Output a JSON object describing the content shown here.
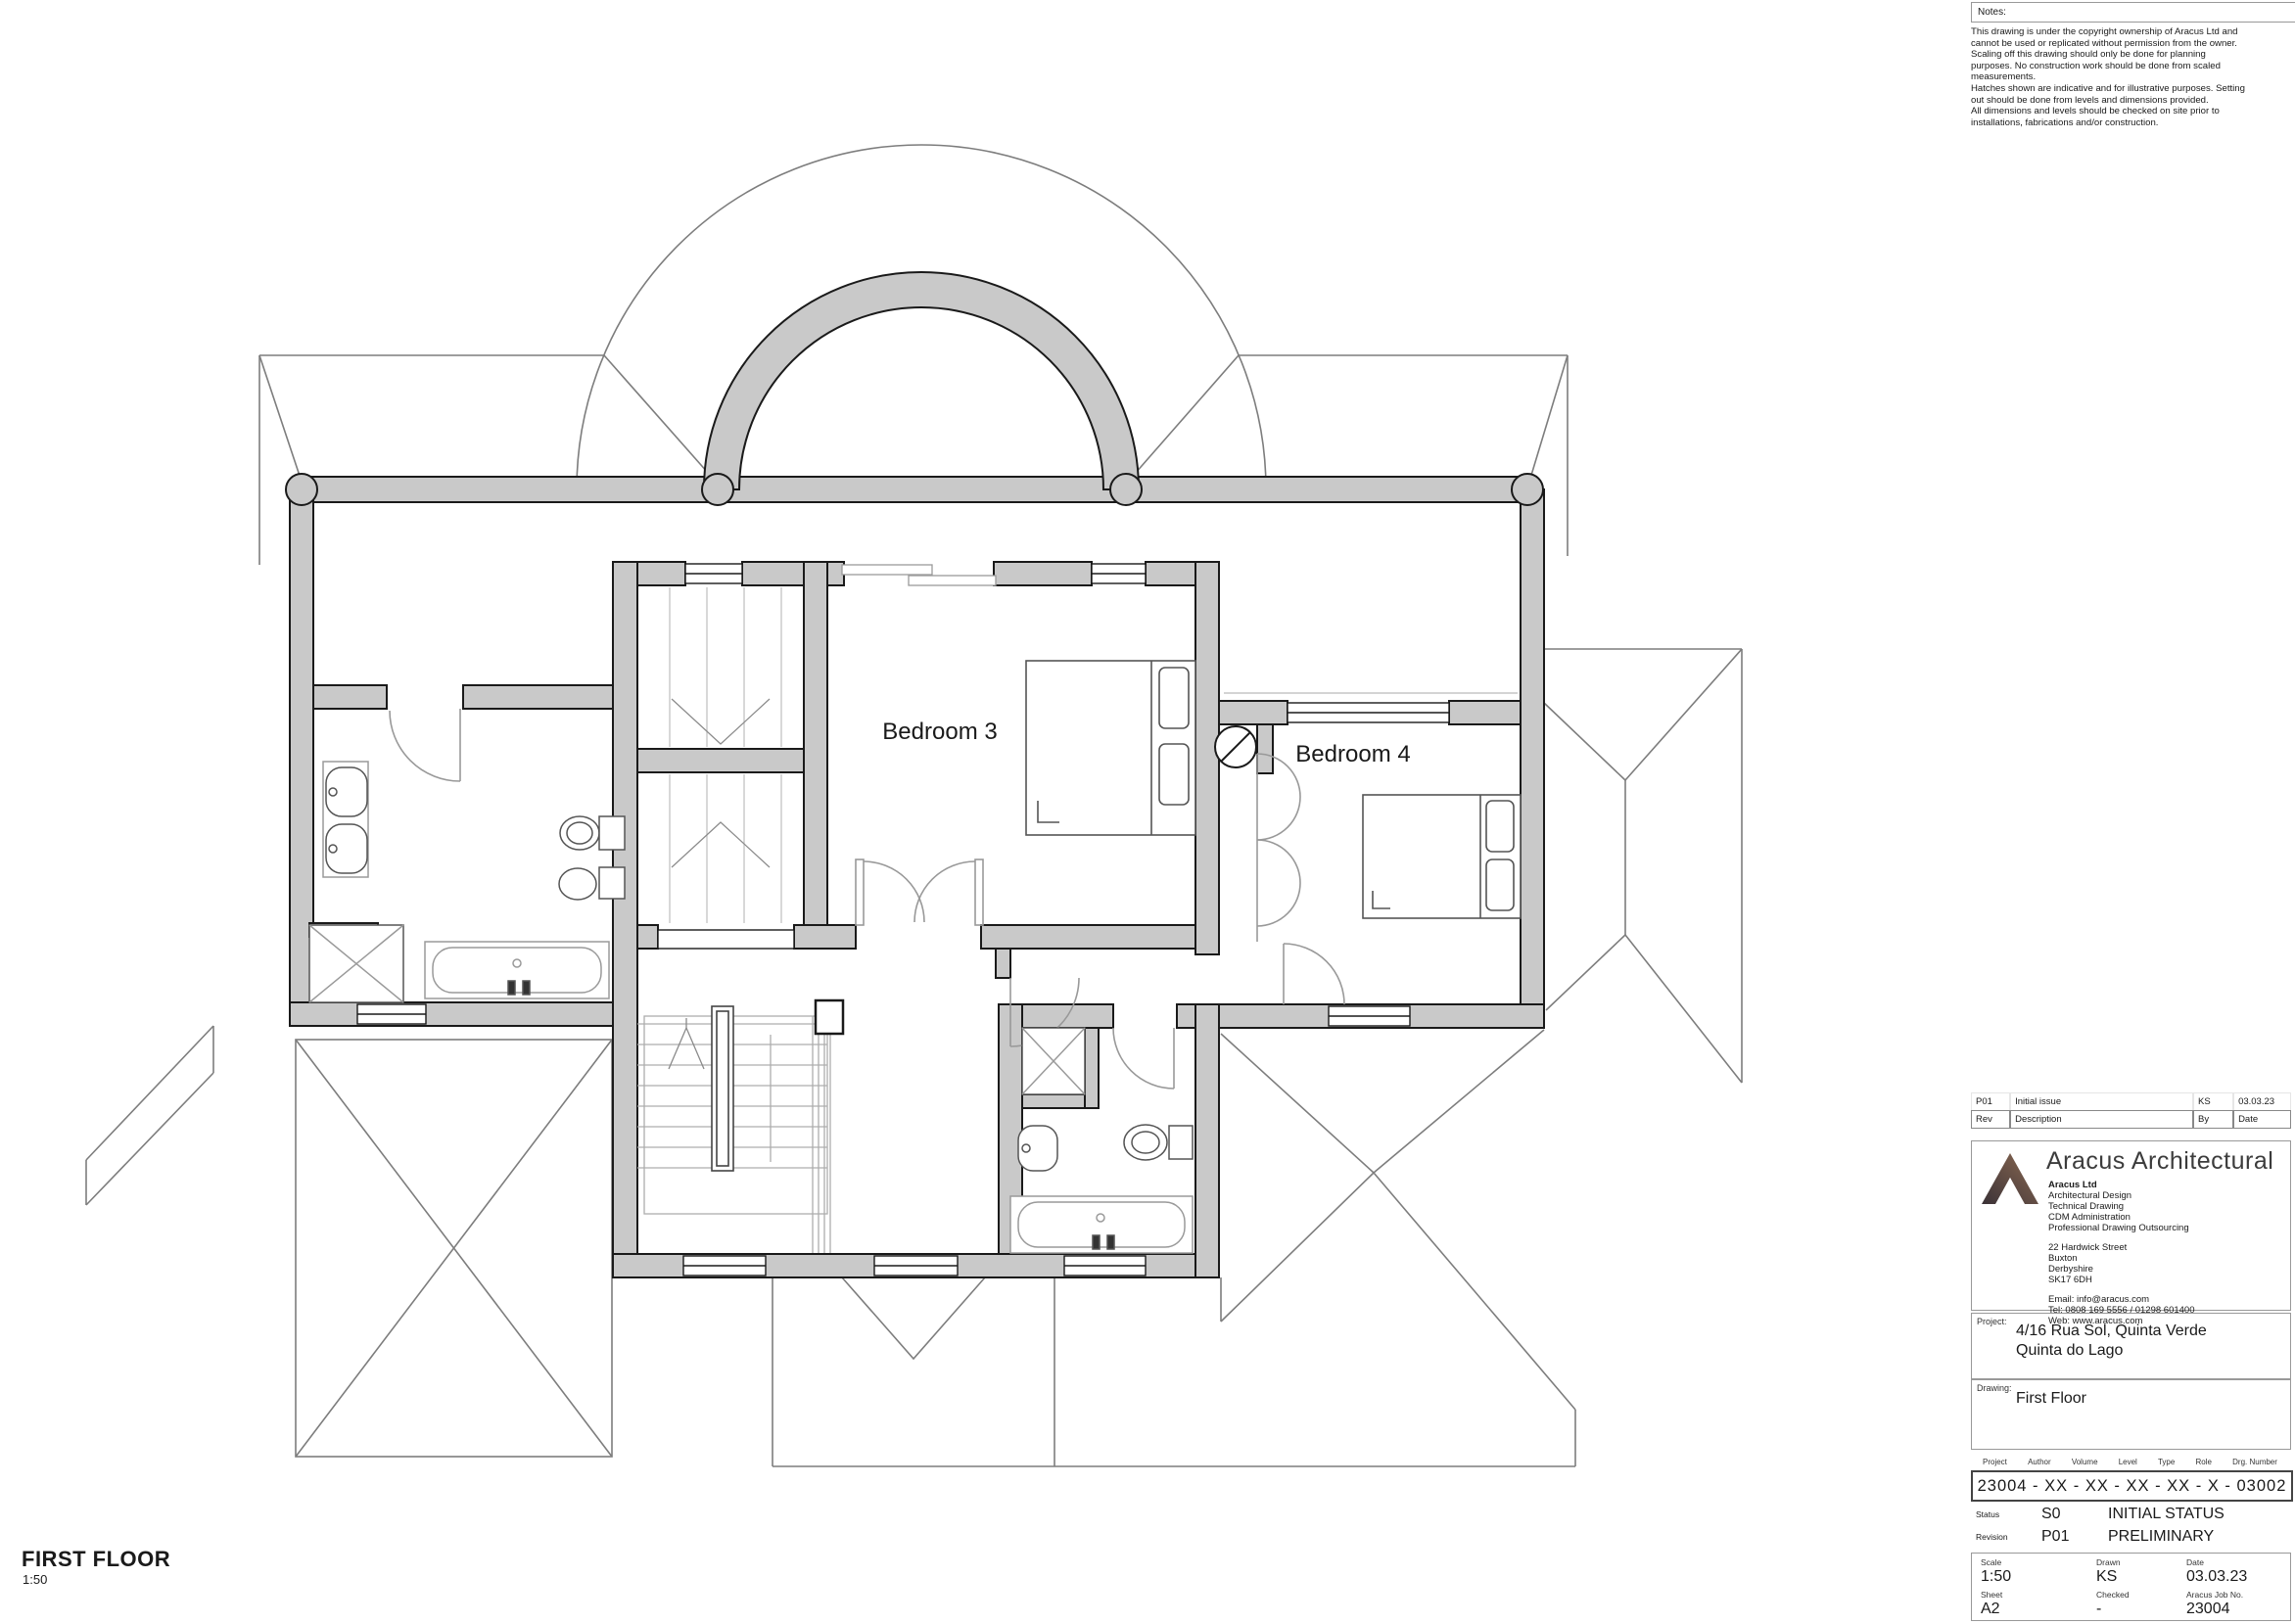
{
  "notes": {
    "label": "Notes:",
    "lines": [
      "This drawing is under the copyright ownership of Aracus Ltd and",
      "cannot be used or replicated without permission from the owner.",
      "Scaling off this drawing should only be done for planning",
      "purposes. No construction work should be done from scaled",
      "measurements.",
      "Hatches shown are indicative and for illustrative purposes. Setting",
      "out should be done from levels and dimensions provided.",
      "All dimensions and levels should be checked on site prior to",
      "installations, fabrications and/or construction."
    ]
  },
  "revision_table": {
    "current": {
      "rev": "P01",
      "description": "Initial issue",
      "by": "KS",
      "date": "03.03.23"
    },
    "headers": {
      "rev": "Rev",
      "description": "Description",
      "by": "By",
      "date": "Date"
    }
  },
  "company": {
    "name": "Aracus Architectural",
    "entity": "Aracus Ltd",
    "services": [
      "Architectural Design",
      "Technical Drawing",
      "CDM Administration",
      "Professional Drawing Outsourcing"
    ],
    "address": [
      "22 Hardwick Street",
      "Buxton",
      "Derbyshire",
      "SK17 6DH"
    ],
    "contact": [
      "Email: info@aracus.com",
      "Tel: 0808 169 5556 / 01298 601400",
      "Web: www.aracus.com"
    ]
  },
  "project": {
    "label": "Project:",
    "line1": "4/16 Rua Sol, Quinta Verde",
    "line2": "Quinta do Lago"
  },
  "drawing": {
    "label": "Drawing:",
    "title": "First Floor"
  },
  "number_fields": {
    "labels": [
      "Project",
      "Author",
      "Volume",
      "Level",
      "Type",
      "Role",
      "Drg. Number"
    ],
    "value": "23004 - XX - XX - XX - XX - X - 03002"
  },
  "status": {
    "label": "Status",
    "code": "S0",
    "text": "INITIAL STATUS"
  },
  "revision": {
    "label": "Revision",
    "code": "P01",
    "text": "PRELIMINARY"
  },
  "info_grid": {
    "scale_label": "Scale",
    "scale": "1:50",
    "drawn_label": "Drawn",
    "drawn": "KS",
    "date_label": "Date",
    "date": "03.03.23",
    "sheet_label": "Sheet",
    "sheet": "A2",
    "checked_label": "Checked",
    "checked": "-",
    "job_label": "Aracus Job No.",
    "job": "23004"
  },
  "plan": {
    "bedroom3": "Bedroom 3",
    "bedroom4": "Bedroom 4"
  },
  "view_title": {
    "name": "FIRST FLOOR",
    "scale": "1:50"
  },
  "colors": {
    "wall": "#c9c9c9",
    "line": "#1a1a1a",
    "roof": "#7d7d7d",
    "logo_dark": "#3b3237",
    "logo_brown": "#8c6a52"
  }
}
